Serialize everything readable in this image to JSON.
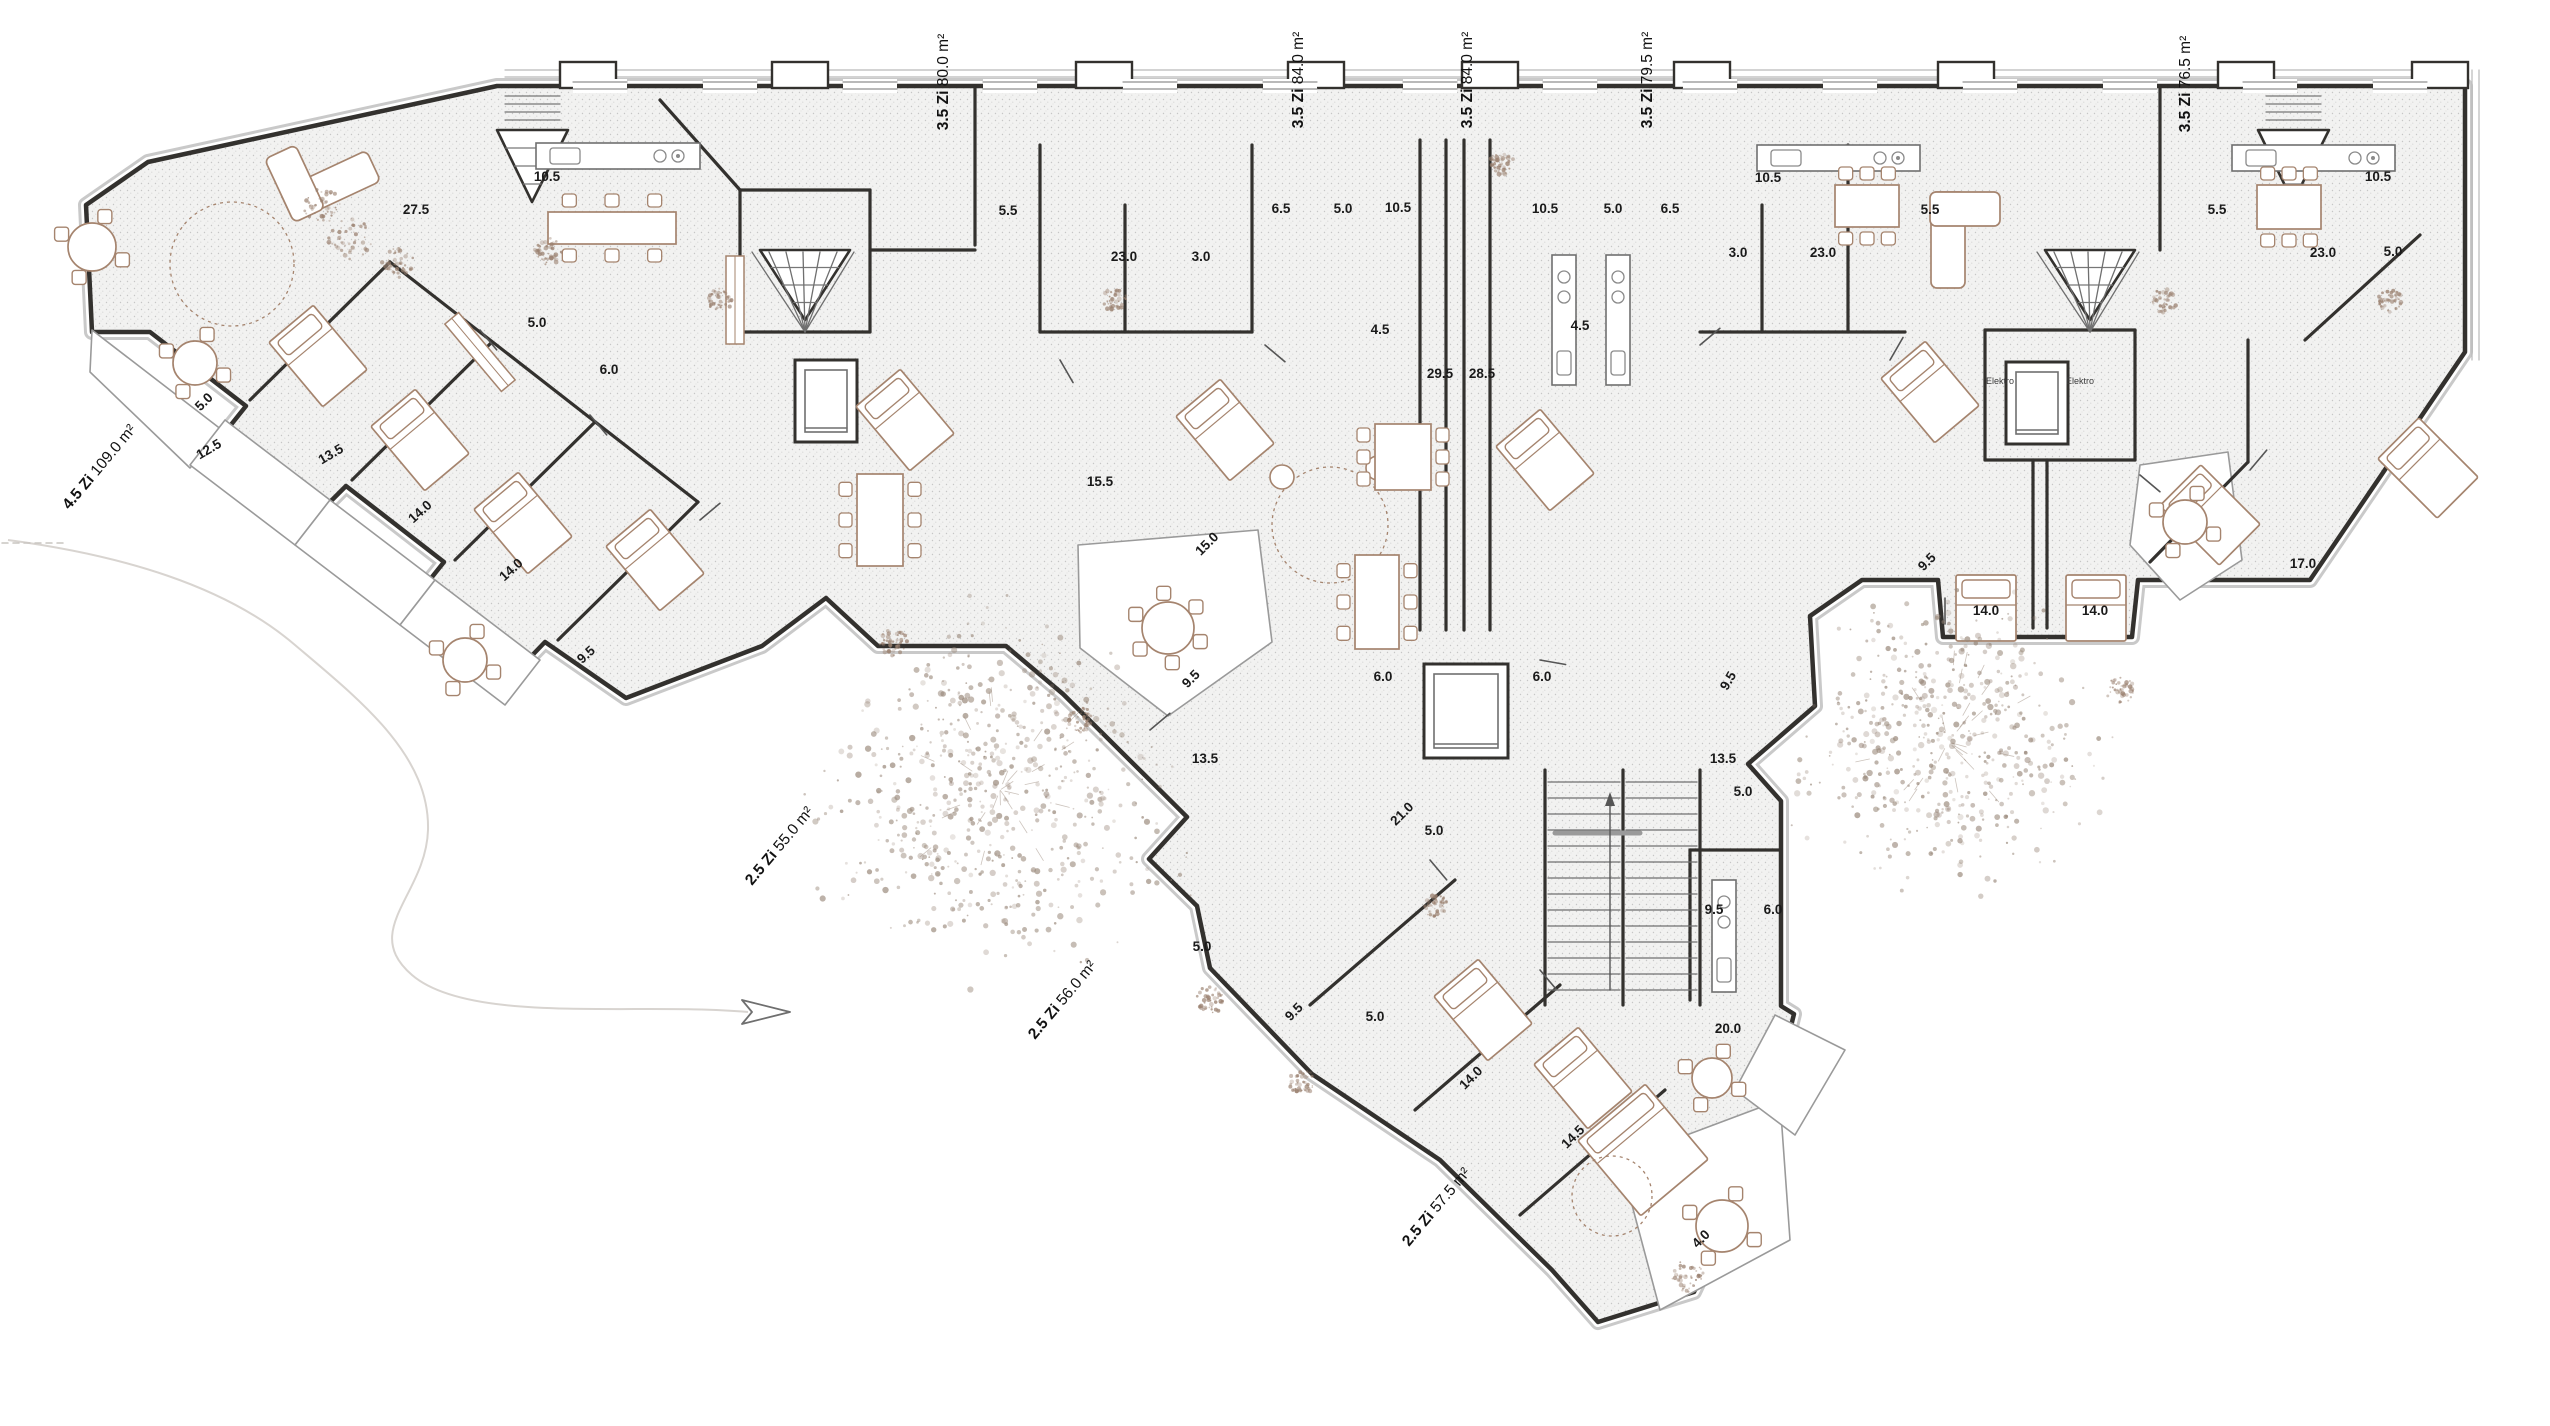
{
  "plan": {
    "apartment_labels": [
      {
        "rooms": "3.5 Zi",
        "area": "80.0 m²",
        "x": 948,
        "y": 82,
        "rot": -90
      },
      {
        "rooms": "3.5 Zi",
        "area": "84.0 m²",
        "x": 1303,
        "y": 80,
        "rot": -90
      },
      {
        "rooms": "3.5 Zi",
        "area": "84.0 m²",
        "x": 1472,
        "y": 80,
        "rot": -90
      },
      {
        "rooms": "3.5 Zi",
        "area": "79.5 m²",
        "x": 1652,
        "y": 80,
        "rot": -90
      },
      {
        "rooms": "3.5 Zi",
        "area": "76.5 m²",
        "x": 2190,
        "y": 84,
        "rot": -90
      },
      {
        "rooms": "4.5 Zi",
        "area": "109.0 m²",
        "x": 103,
        "y": 470,
        "rot": -50
      },
      {
        "rooms": "2.5 Zi",
        "area": "55.0 m²",
        "x": 783,
        "y": 849,
        "rot": -50
      },
      {
        "rooms": "2.5 Zi",
        "area": "56.0 m²",
        "x": 1066,
        "y": 1003,
        "rot": -50
      },
      {
        "rooms": "2.5 Zi",
        "area": "57.5 m²",
        "x": 1440,
        "y": 1210,
        "rot": -50
      }
    ],
    "room_labels": [
      {
        "t": "10.5",
        "x": 547,
        "y": 181,
        "r": 0
      },
      {
        "t": "27.5",
        "x": 416,
        "y": 214,
        "r": 0
      },
      {
        "t": "5.0",
        "x": 537,
        "y": 327,
        "r": 0
      },
      {
        "t": "6.0",
        "x": 609,
        "y": 374,
        "r": 0
      },
      {
        "t": "5.0",
        "x": 207,
        "y": 405,
        "r": -45
      },
      {
        "t": "12.5",
        "x": 211,
        "y": 453,
        "r": -30
      },
      {
        "t": "13.5",
        "x": 333,
        "y": 458,
        "r": -30
      },
      {
        "t": "14.0",
        "x": 423,
        "y": 515,
        "r": -42
      },
      {
        "t": "14.0",
        "x": 514,
        "y": 573,
        "r": -42
      },
      {
        "t": "9.5",
        "x": 589,
        "y": 658,
        "r": -42
      },
      {
        "t": "5.5",
        "x": 1008,
        "y": 215,
        "r": 0
      },
      {
        "t": "23.0",
        "x": 1124,
        "y": 261,
        "r": 0
      },
      {
        "t": "3.0",
        "x": 1201,
        "y": 261,
        "r": 0
      },
      {
        "t": "6.5",
        "x": 1281,
        "y": 213,
        "r": 0
      },
      {
        "t": "5.0",
        "x": 1343,
        "y": 213,
        "r": 0
      },
      {
        "t": "10.5",
        "x": 1398,
        "y": 212,
        "r": 0
      },
      {
        "t": "10.5",
        "x": 1545,
        "y": 213,
        "r": 0
      },
      {
        "t": "5.0",
        "x": 1613,
        "y": 213,
        "r": 0
      },
      {
        "t": "6.5",
        "x": 1670,
        "y": 213,
        "r": 0
      },
      {
        "t": "10.5",
        "x": 1768,
        "y": 182,
        "r": 0
      },
      {
        "t": "3.0",
        "x": 1738,
        "y": 257,
        "r": 0
      },
      {
        "t": "23.0",
        "x": 1823,
        "y": 257,
        "r": 0
      },
      {
        "t": "5.5",
        "x": 1930,
        "y": 214,
        "r": 0
      },
      {
        "t": "5.5",
        "x": 2217,
        "y": 214,
        "r": 0
      },
      {
        "t": "10.5",
        "x": 2378,
        "y": 181,
        "r": 0
      },
      {
        "t": "23.0",
        "x": 2323,
        "y": 257,
        "r": 0
      },
      {
        "t": "5.0",
        "x": 2393,
        "y": 256,
        "r": 0
      },
      {
        "t": "4.5",
        "x": 1380,
        "y": 334,
        "r": 0
      },
      {
        "t": "4.5",
        "x": 1580,
        "y": 330,
        "r": 0
      },
      {
        "t": "29.5",
        "x": 1440,
        "y": 378,
        "r": 0
      },
      {
        "t": "28.5",
        "x": 1482,
        "y": 378,
        "r": 0
      },
      {
        "t": "15.5",
        "x": 1100,
        "y": 486,
        "r": 0
      },
      {
        "t": "15.0",
        "x": 1210,
        "y": 547,
        "r": -45
      },
      {
        "t": "9.5",
        "x": 1194,
        "y": 682,
        "r": -45
      },
      {
        "t": "13.5",
        "x": 1205,
        "y": 763,
        "r": 0
      },
      {
        "t": "6.0",
        "x": 1383,
        "y": 681,
        "r": 0
      },
      {
        "t": "6.0",
        "x": 1542,
        "y": 681,
        "r": 0
      },
      {
        "t": "9.5",
        "x": 1732,
        "y": 683,
        "r": -60
      },
      {
        "t": "13.5",
        "x": 1723,
        "y": 763,
        "r": 0
      },
      {
        "t": "5.0",
        "x": 1743,
        "y": 796,
        "r": 0
      },
      {
        "t": "21.0",
        "x": 1405,
        "y": 817,
        "r": -45
      },
      {
        "t": "5.0",
        "x": 1434,
        "y": 835,
        "r": 0
      },
      {
        "t": "5.0",
        "x": 1202,
        "y": 951,
        "r": 0
      },
      {
        "t": "9.5",
        "x": 1297,
        "y": 1015,
        "r": -45
      },
      {
        "t": "5.0",
        "x": 1375,
        "y": 1021,
        "r": 0
      },
      {
        "t": "9.5",
        "x": 1714,
        "y": 914,
        "r": 0
      },
      {
        "t": "6.0",
        "x": 1773,
        "y": 914,
        "r": 0
      },
      {
        "t": "20.0",
        "x": 1728,
        "y": 1033,
        "r": 0
      },
      {
        "t": "14.0",
        "x": 1474,
        "y": 1081,
        "r": -45
      },
      {
        "t": "14.5",
        "x": 1576,
        "y": 1140,
        "r": -45
      },
      {
        "t": "4.0",
        "x": 1704,
        "y": 1242,
        "r": -45
      },
      {
        "t": "9.5",
        "x": 1930,
        "y": 565,
        "r": -45
      },
      {
        "t": "14.0",
        "x": 1986,
        "y": 615,
        "r": 0
      },
      {
        "t": "14.0",
        "x": 2095,
        "y": 615,
        "r": 0
      },
      {
        "t": "17.0",
        "x": 2303,
        "y": 568,
        "r": 0
      }
    ],
    "utility_labels": [
      {
        "t": "Elektro",
        "x": 2000,
        "y": 384
      },
      {
        "t": "Elektro",
        "x": 2080,
        "y": 384
      }
    ]
  },
  "colors": {
    "wall": "#33312e",
    "wall_light": "#c9c9c9",
    "furniture": "#a5846e",
    "vegetation": "#9a897b",
    "stipple": "#c6c6c6",
    "floor": "#f2f2f1",
    "paper": "#ffffff",
    "label": "#1a1a1a"
  }
}
